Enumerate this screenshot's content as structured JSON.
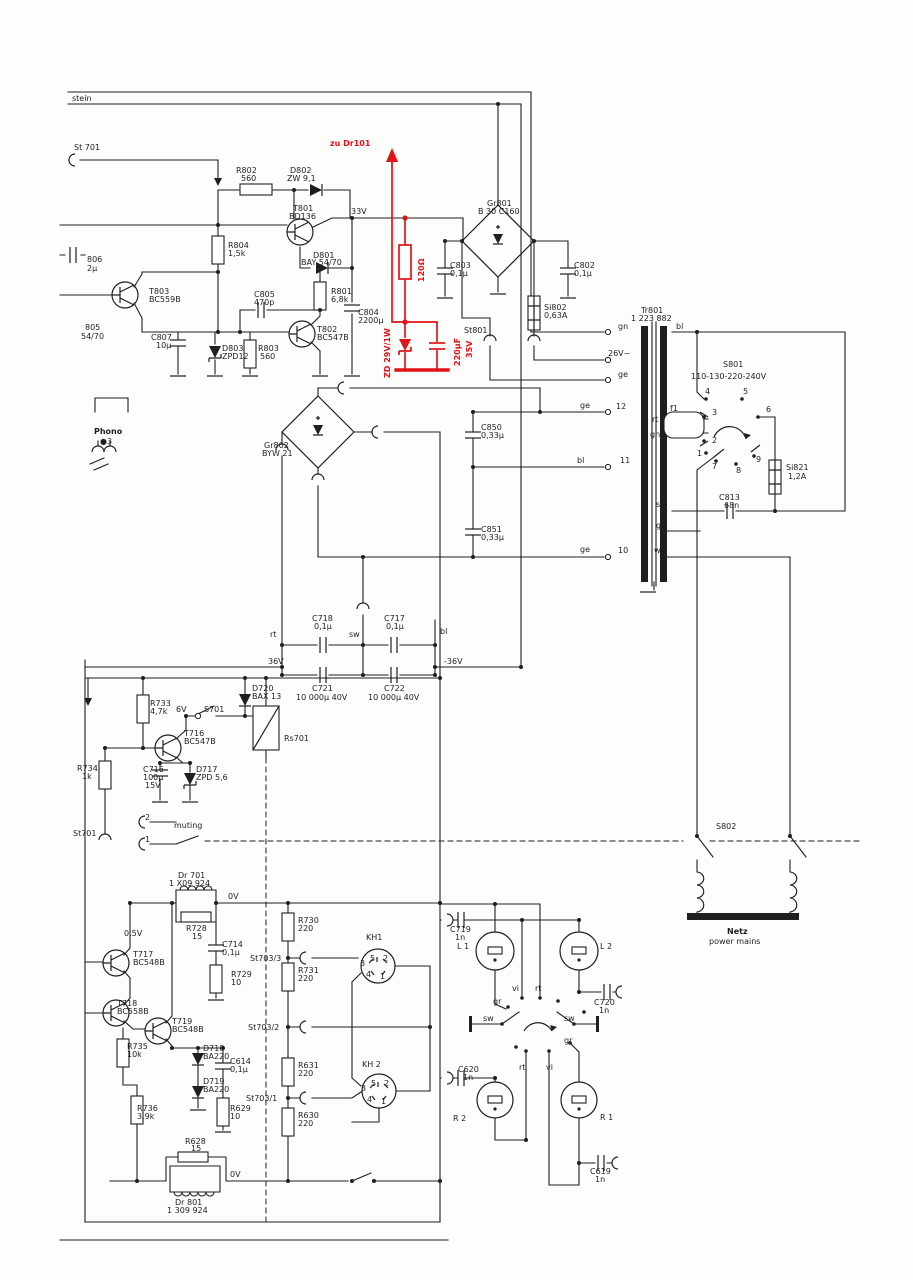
{
  "meta": {
    "type": "scanned schematic diagram",
    "section": "power supply / mains board with muting and headphone wiring",
    "annotation_color": "#e01317",
    "ink_color": "#1f1f1f",
    "paper_color": "#fdfdfc"
  },
  "modification": {
    "note": "zu Dr101",
    "parts": [
      "120Ω",
      "ZD 29V/1W",
      "220µF 35V"
    ]
  },
  "labels": [
    {
      "t": "stein",
      "x": 72,
      "y": 101
    },
    {
      "t": "St 701",
      "x": 74,
      "y": 150
    },
    {
      "t": "zu Dr101",
      "x": 330,
      "y": 146,
      "c": "red",
      "f": 13,
      "b": 1
    },
    {
      "t": "R802",
      "x": 236,
      "y": 173
    },
    {
      "t": "560",
      "x": 241,
      "y": 181
    },
    {
      "t": "D802",
      "x": 290,
      "y": 173
    },
    {
      "t": "ZW 9,1",
      "x": 287,
      "y": 181
    },
    {
      "t": "T801",
      "x": 293,
      "y": 211
    },
    {
      "t": "BD136",
      "x": 289,
      "y": 219
    },
    {
      "t": "33V",
      "x": 351,
      "y": 214
    },
    {
      "t": "R804",
      "x": 228,
      "y": 248
    },
    {
      "t": "1,5k",
      "x": 228,
      "y": 256
    },
    {
      "t": "D801",
      "x": 313,
      "y": 258
    },
    {
      "t": "BAY 54/70",
      "x": 301,
      "y": 265
    },
    {
      "t": "T803",
      "x": 149,
      "y": 294
    },
    {
      "t": "BC559B",
      "x": 149,
      "y": 302
    },
    {
      "t": "R801",
      "x": 331,
      "y": 294
    },
    {
      "t": "6,8k",
      "x": 331,
      "y": 302
    },
    {
      "t": "C805",
      "x": 254,
      "y": 297
    },
    {
      "t": "470p",
      "x": 254,
      "y": 305
    },
    {
      "t": "C804",
      "x": 358,
      "y": 315
    },
    {
      "t": "2200µ",
      "x": 358,
      "y": 323
    },
    {
      "t": "T802",
      "x": 317,
      "y": 332
    },
    {
      "t": "BC547B",
      "x": 317,
      "y": 340
    },
    {
      "t": "C807",
      "x": 151,
      "y": 340
    },
    {
      "t": "10µ",
      "x": 156,
      "y": 348
    },
    {
      "t": "D803",
      "x": 222,
      "y": 351
    },
    {
      "t": "ZPD12",
      "x": 222,
      "y": 359
    },
    {
      "t": "R803",
      "x": 258,
      "y": 351
    },
    {
      "t": "560",
      "x": 260,
      "y": 359
    },
    {
      "t": "806",
      "x": 87,
      "y": 262
    },
    {
      "t": "2µ",
      "x": 87,
      "y": 271
    },
    {
      "t": "805",
      "x": 85,
      "y": 330
    },
    {
      "t": "54/70",
      "x": 81,
      "y": 339
    },
    {
      "t": "Phono",
      "x": 94,
      "y": 434,
      "b": 1
    },
    {
      "t": "●3",
      "x": 100,
      "y": 444,
      "f": 7
    },
    {
      "t": "120Ω",
      "x": 424,
      "y": 282,
      "r": -90,
      "c": "red",
      "f": 12,
      "b": 1
    },
    {
      "t": "ZD 29V/1W",
      "x": 390,
      "y": 378,
      "r": -90,
      "c": "red",
      "f": 11,
      "b": 1
    },
    {
      "t": "220µF",
      "x": 460,
      "y": 366,
      "r": -90,
      "c": "red",
      "f": 11,
      "b": 1
    },
    {
      "t": "35V",
      "x": 472,
      "y": 358,
      "r": -90,
      "c": "red",
      "f": 11,
      "b": 1
    },
    {
      "t": "Gr801",
      "x": 487,
      "y": 206
    },
    {
      "t": "B 30 C160",
      "x": 478,
      "y": 214
    },
    {
      "t": "C803",
      "x": 450,
      "y": 268
    },
    {
      "t": "0,1µ",
      "x": 450,
      "y": 276
    },
    {
      "t": "Si802",
      "x": 544,
      "y": 310
    },
    {
      "t": "0,63A",
      "x": 544,
      "y": 318
    },
    {
      "t": "C802",
      "x": 574,
      "y": 268
    },
    {
      "t": "0,1µ",
      "x": 574,
      "y": 276
    },
    {
      "t": "St801",
      "x": 464,
      "y": 333
    },
    {
      "t": "Tr801",
      "x": 641,
      "y": 313
    },
    {
      "t": "1 223 882",
      "x": 631,
      "y": 321
    },
    {
      "t": "gn",
      "x": 618,
      "y": 329
    },
    {
      "t": "26V~",
      "x": 608,
      "y": 356
    },
    {
      "t": "ge",
      "x": 618,
      "y": 377
    },
    {
      "t": "12",
      "x": 616,
      "y": 409
    },
    {
      "t": "bl",
      "x": 676,
      "y": 329
    },
    {
      "t": "S801",
      "x": 723,
      "y": 367
    },
    {
      "t": "110-130-220-240V",
      "x": 691,
      "y": 379
    },
    {
      "t": "f1",
      "x": 670,
      "y": 411
    },
    {
      "t": "rt",
      "x": 652,
      "y": 422
    },
    {
      "t": "3",
      "x": 712,
      "y": 415
    },
    {
      "t": "gn",
      "x": 650,
      "y": 437
    },
    {
      "t": "2",
      "x": 712,
      "y": 443
    },
    {
      "t": "4",
      "x": 705,
      "y": 394
    },
    {
      "t": "5",
      "x": 743,
      "y": 394
    },
    {
      "t": "6",
      "x": 766,
      "y": 412
    },
    {
      "t": "1",
      "x": 697,
      "y": 456
    },
    {
      "t": "7",
      "x": 712,
      "y": 469
    },
    {
      "t": "8",
      "x": 736,
      "y": 473
    },
    {
      "t": "9",
      "x": 756,
      "y": 462
    },
    {
      "t": "Si821",
      "x": 786,
      "y": 470
    },
    {
      "t": "1,2A",
      "x": 788,
      "y": 479
    },
    {
      "t": "C813",
      "x": 719,
      "y": 500
    },
    {
      "t": "68n",
      "x": 724,
      "y": 508
    },
    {
      "t": "sw",
      "x": 656,
      "y": 507
    },
    {
      "t": "gr",
      "x": 656,
      "y": 528
    },
    {
      "t": "ws",
      "x": 654,
      "y": 553
    },
    {
      "t": "11",
      "x": 620,
      "y": 463
    },
    {
      "t": "10",
      "x": 618,
      "y": 553
    },
    {
      "t": "ge",
      "x": 580,
      "y": 408
    },
    {
      "t": "bl",
      "x": 577,
      "y": 463
    },
    {
      "t": "ge",
      "x": 580,
      "y": 552
    },
    {
      "t": "C850",
      "x": 481,
      "y": 430
    },
    {
      "t": "0,33µ",
      "x": 481,
      "y": 438
    },
    {
      "t": "C851",
      "x": 481,
      "y": 532
    },
    {
      "t": "0,33µ",
      "x": 481,
      "y": 540
    },
    {
      "t": "Gr802",
      "x": 264,
      "y": 448
    },
    {
      "t": "BYW 21",
      "x": 262,
      "y": 456
    },
    {
      "t": "rt",
      "x": 270,
      "y": 637
    },
    {
      "t": "sw",
      "x": 349,
      "y": 637
    },
    {
      "t": "bl",
      "x": 440,
      "y": 634
    },
    {
      "t": "C718",
      "x": 312,
      "y": 621
    },
    {
      "t": "0,1µ",
      "x": 314,
      "y": 629
    },
    {
      "t": "C717",
      "x": 384,
      "y": 621
    },
    {
      "t": "0,1µ",
      "x": 386,
      "y": 629
    },
    {
      "t": "36V",
      "x": 268,
      "y": 664
    },
    {
      "t": "-36V",
      "x": 444,
      "y": 664
    },
    {
      "t": "C721",
      "x": 312,
      "y": 691
    },
    {
      "t": "10 000µ 40V",
      "x": 296,
      "y": 700
    },
    {
      "t": "C722",
      "x": 384,
      "y": 691
    },
    {
      "t": "10 000µ 40V",
      "x": 368,
      "y": 700
    },
    {
      "t": "R733",
      "x": 150,
      "y": 706
    },
    {
      "t": "4,7k",
      "x": 150,
      "y": 714
    },
    {
      "t": "D720",
      "x": 252,
      "y": 691
    },
    {
      "t": "BAX 13",
      "x": 252,
      "y": 699
    },
    {
      "t": "6V",
      "x": 176,
      "y": 712
    },
    {
      "t": "S701",
      "x": 204,
      "y": 712
    },
    {
      "t": "Rs701",
      "x": 284,
      "y": 741
    },
    {
      "t": "T716",
      "x": 184,
      "y": 736
    },
    {
      "t": "BC547B",
      "x": 184,
      "y": 744
    },
    {
      "t": "R734",
      "x": 77,
      "y": 771
    },
    {
      "t": "1k",
      "x": 82,
      "y": 779
    },
    {
      "t": "C716",
      "x": 143,
      "y": 772
    },
    {
      "t": "100µ",
      "x": 143,
      "y": 780
    },
    {
      "t": "15V",
      "x": 145,
      "y": 788
    },
    {
      "t": "D717",
      "x": 196,
      "y": 772
    },
    {
      "t": "ZPD 5,6",
      "x": 196,
      "y": 780
    },
    {
      "t": "St701",
      "x": 73,
      "y": 836
    },
    {
      "t": "muting",
      "x": 174,
      "y": 828
    },
    {
      "t": "2",
      "x": 145,
      "y": 820
    },
    {
      "t": "1",
      "x": 145,
      "y": 842
    },
    {
      "t": "Dr 701",
      "x": 178,
      "y": 878
    },
    {
      "t": "1 X09 924",
      "x": 169,
      "y": 886
    },
    {
      "t": "0V",
      "x": 228,
      "y": 899
    },
    {
      "t": "R728",
      "x": 186,
      "y": 931
    },
    {
      "t": "15",
      "x": 192,
      "y": 939
    },
    {
      "t": "0,5V",
      "x": 124,
      "y": 936
    },
    {
      "t": "T717",
      "x": 133,
      "y": 957
    },
    {
      "t": "BC548B",
      "x": 133,
      "y": 965
    },
    {
      "t": "C714",
      "x": 222,
      "y": 947
    },
    {
      "t": "0,1µ",
      "x": 222,
      "y": 955
    },
    {
      "t": "R729",
      "x": 231,
      "y": 977
    },
    {
      "t": "10",
      "x": 231,
      "y": 985
    },
    {
      "t": "T718",
      "x": 117,
      "y": 1006
    },
    {
      "t": "BC558B",
      "x": 117,
      "y": 1014
    },
    {
      "t": "T719",
      "x": 172,
      "y": 1024
    },
    {
      "t": "BC548B",
      "x": 172,
      "y": 1032
    },
    {
      "t": "R735",
      "x": 127,
      "y": 1049
    },
    {
      "t": "10k",
      "x": 127,
      "y": 1057
    },
    {
      "t": "D718",
      "x": 203,
      "y": 1051
    },
    {
      "t": "BA220",
      "x": 203,
      "y": 1059
    },
    {
      "t": "C614",
      "x": 230,
      "y": 1064
    },
    {
      "t": "0,1µ",
      "x": 230,
      "y": 1072
    },
    {
      "t": "D719",
      "x": 203,
      "y": 1084
    },
    {
      "t": "BA220",
      "x": 203,
      "y": 1092
    },
    {
      "t": "R736",
      "x": 137,
      "y": 1111
    },
    {
      "t": "3,9k",
      "x": 137,
      "y": 1119
    },
    {
      "t": "R629",
      "x": 230,
      "y": 1111
    },
    {
      "t": "10",
      "x": 230,
      "y": 1119
    },
    {
      "t": "R628",
      "x": 185,
      "y": 1144
    },
    {
      "t": "15",
      "x": 191,
      "y": 1151
    },
    {
      "t": "0V",
      "x": 230,
      "y": 1177
    },
    {
      "t": "Dr 801",
      "x": 175,
      "y": 1205
    },
    {
      "t": "1 309 924",
      "x": 167,
      "y": 1213
    },
    {
      "t": "R730",
      "x": 298,
      "y": 923
    },
    {
      "t": "220",
      "x": 298,
      "y": 931
    },
    {
      "t": "St703/3",
      "x": 250,
      "y": 961
    },
    {
      "t": "R731",
      "x": 298,
      "y": 973
    },
    {
      "t": "220",
      "x": 298,
      "y": 981
    },
    {
      "t": "KH1",
      "x": 366,
      "y": 940
    },
    {
      "t": "St703/2",
      "x": 248,
      "y": 1030
    },
    {
      "t": "R631",
      "x": 298,
      "y": 1068
    },
    {
      "t": "220",
      "x": 298,
      "y": 1076
    },
    {
      "t": "KH 2",
      "x": 362,
      "y": 1067
    },
    {
      "t": "St703/1",
      "x": 246,
      "y": 1101
    },
    {
      "t": "R630",
      "x": 298,
      "y": 1118
    },
    {
      "t": "220",
      "x": 298,
      "y": 1126
    },
    {
      "t": "5",
      "x": 370,
      "y": 961,
      "f": 6
    },
    {
      "t": "2",
      "x": 383,
      "y": 961,
      "f": 6
    },
    {
      "t": "3",
      "x": 360,
      "y": 966,
      "f": 6
    },
    {
      "t": "4",
      "x": 366,
      "y": 977,
      "f": 6
    },
    {
      "t": "1",
      "x": 380,
      "y": 979,
      "f": 6
    },
    {
      "t": "5",
      "x": 371,
      "y": 1086,
      "f": 6
    },
    {
      "t": "2",
      "x": 384,
      "y": 1086,
      "f": 6
    },
    {
      "t": "3",
      "x": 361,
      "y": 1091,
      "f": 6
    },
    {
      "t": "4",
      "x": 367,
      "y": 1102,
      "f": 6
    },
    {
      "t": "1",
      "x": 381,
      "y": 1104,
      "f": 6
    },
    {
      "t": "C719",
      "x": 450,
      "y": 932
    },
    {
      "t": "1n",
      "x": 455,
      "y": 940
    },
    {
      "t": "L 1",
      "x": 457,
      "y": 949
    },
    {
      "t": "L 2",
      "x": 600,
      "y": 949
    },
    {
      "t": "C720",
      "x": 594,
      "y": 1005
    },
    {
      "t": "1n",
      "x": 599,
      "y": 1013
    },
    {
      "t": "vi",
      "x": 512,
      "y": 991
    },
    {
      "t": "rt",
      "x": 535,
      "y": 991
    },
    {
      "t": "gr",
      "x": 493,
      "y": 1004
    },
    {
      "t": "sw",
      "x": 483,
      "y": 1021
    },
    {
      "t": "sw",
      "x": 564,
      "y": 1021
    },
    {
      "t": "gr",
      "x": 564,
      "y": 1043
    },
    {
      "t": "rt",
      "x": 519,
      "y": 1070
    },
    {
      "t": "vi",
      "x": 546,
      "y": 1070
    },
    {
      "t": "C620",
      "x": 458,
      "y": 1072
    },
    {
      "t": "1n",
      "x": 463,
      "y": 1080
    },
    {
      "t": "R 2",
      "x": 453,
      "y": 1121
    },
    {
      "t": "R 1",
      "x": 600,
      "y": 1120
    },
    {
      "t": "C619",
      "x": 590,
      "y": 1174
    },
    {
      "t": "1n",
      "x": 595,
      "y": 1182
    },
    {
      "t": "S802",
      "x": 716,
      "y": 829
    },
    {
      "t": "Netz",
      "x": 727,
      "y": 934,
      "b": 1
    },
    {
      "t": "power mains",
      "x": 709,
      "y": 944
    }
  ]
}
